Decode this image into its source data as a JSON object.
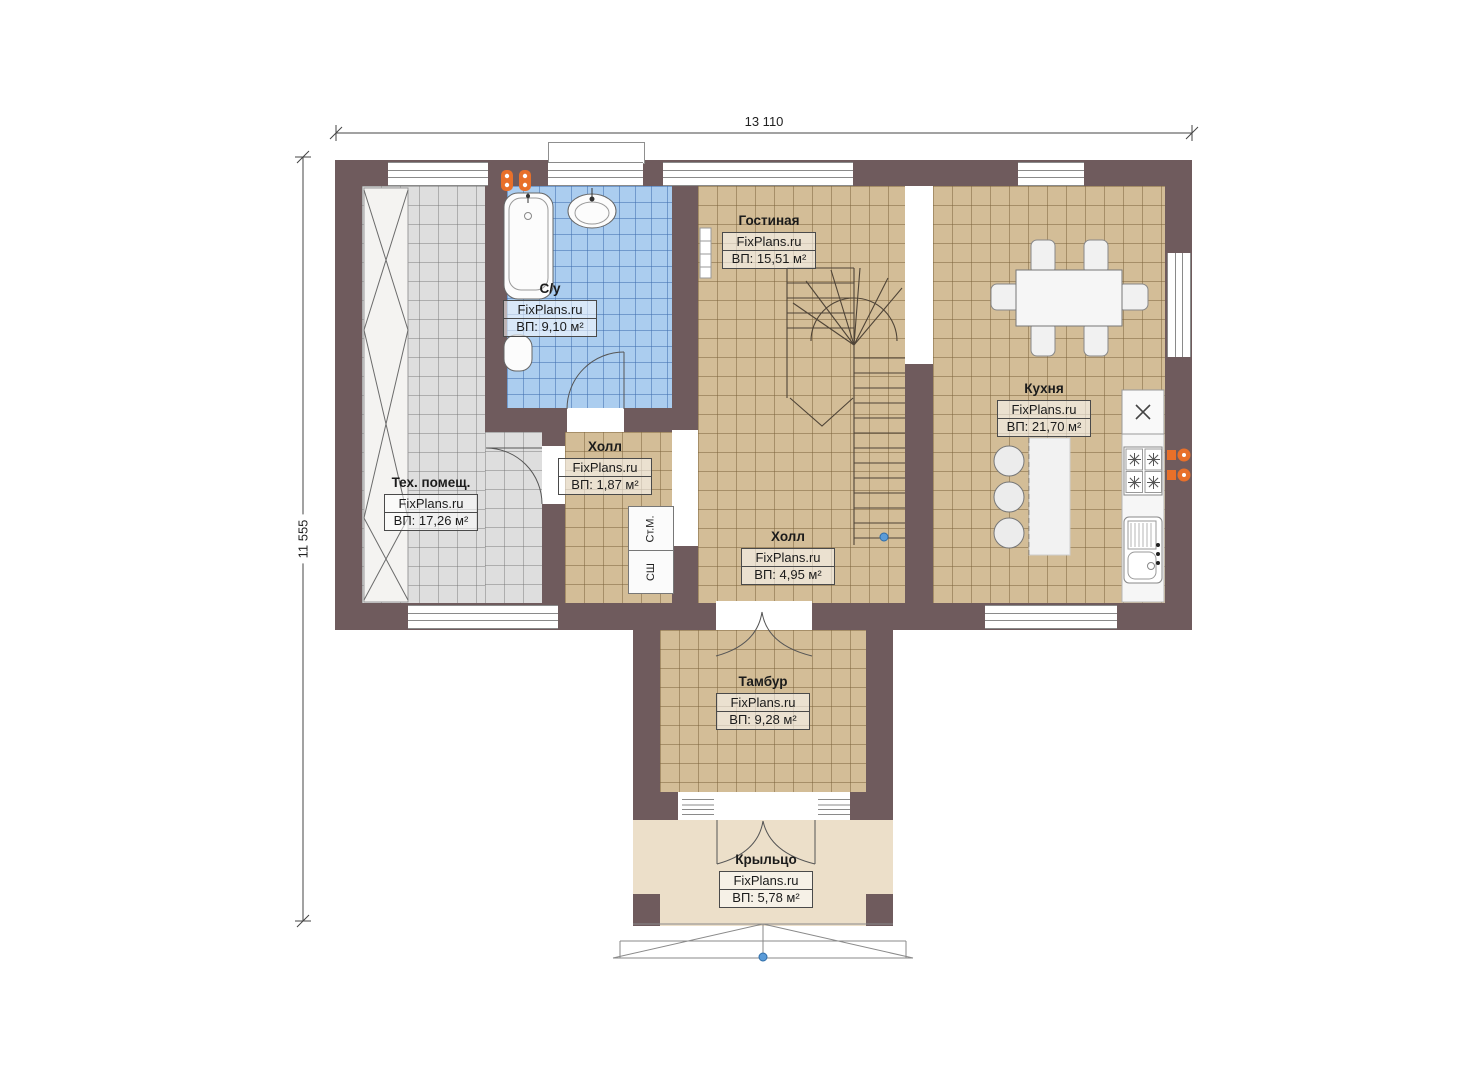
{
  "plan": {
    "dimensions": {
      "width": "13 110",
      "height": "11 555"
    },
    "rooms": [
      {
        "name": "Гостиная",
        "brand": "FixPlans.ru",
        "area": "ВП: 15,51 м²"
      },
      {
        "name": "Кухня",
        "brand": "FixPlans.ru",
        "area": "ВП: 21,70 м²"
      },
      {
        "name": "С/у",
        "brand": "FixPlans.ru",
        "area": "ВП: 9,10 м²"
      },
      {
        "name": "Тех. помещ.",
        "brand": "FixPlans.ru",
        "area": "ВП: 17,26 м²"
      },
      {
        "name": "Холл",
        "brand": "FixPlans.ru",
        "area": "ВП: 1,87 м²"
      },
      {
        "name": "Холл",
        "brand": "FixPlans.ru",
        "area": "ВП: 4,95 м²"
      },
      {
        "name": "Тамбур",
        "brand": "FixPlans.ru",
        "area": "ВП: 9,28 м²"
      },
      {
        "name": "Крыльцо",
        "brand": "FixPlans.ru",
        "area": "ВП: 5,78 м²"
      }
    ],
    "appliances": {
      "washing_machine": "Ст.М.",
      "drying_cabinet": "СШ"
    },
    "colors": {
      "wall": "#6f5b5d",
      "floor_beige": "#d3bd97",
      "floor_gray": "#dedede",
      "floor_blue": "#abcdef",
      "floor_porch": "#ecdfc9",
      "accent_orange": "#e8702a",
      "marker_blue": "#5a9bd8"
    }
  }
}
